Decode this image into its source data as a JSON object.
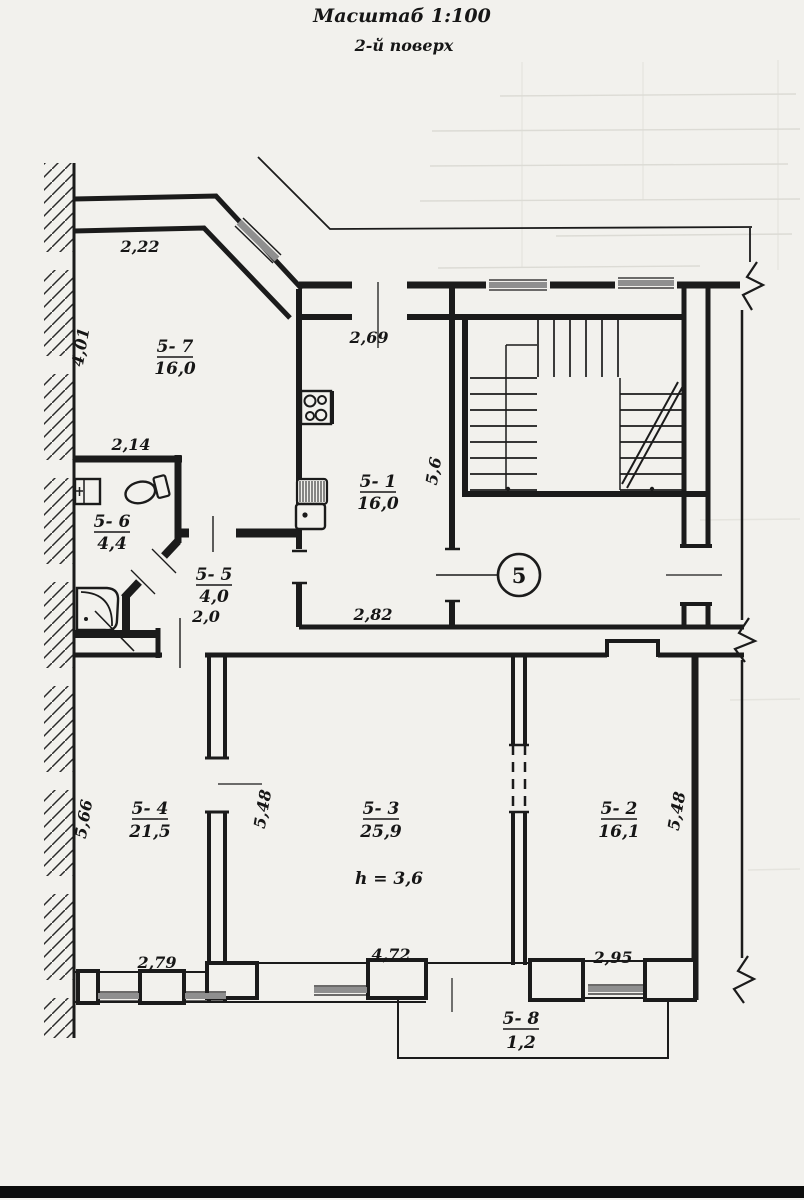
{
  "title": "Масштаб 1:100",
  "subtitle": "2-й поверх",
  "apartment_number": "5",
  "height_note": "h = 3,6",
  "rooms": [
    {
      "id": "5- 7",
      "area": "16,0"
    },
    {
      "id": "5- 1",
      "area": "16,0"
    },
    {
      "id": "5- 6",
      "area": "4,4"
    },
    {
      "id": "5- 5",
      "area": "4,0"
    },
    {
      "id": "5- 4",
      "area": "21,5"
    },
    {
      "id": "5- 3",
      "area": "25,9"
    },
    {
      "id": "5- 2",
      "area": "16,1"
    },
    {
      "id": "5- 8",
      "area": "1,2"
    }
  ],
  "dimensions": {
    "room_5_7_top": "2,22",
    "room_5_7_left": "4,01",
    "kitchen_top": "2,69",
    "kitchen_right": "5,6",
    "kitchen_bottom": "2,82",
    "bathroom_top": "2,14",
    "hall_width": "2,0",
    "room_5_4_left": "5,66",
    "room_5_4_right": "5,48",
    "room_5_4_bottom": "2,79",
    "room_5_3_bottom": "4,72",
    "room_5_2_right": "5,48",
    "room_5_2_bottom": "2,95"
  },
  "colors": {
    "paper": "#f2f1ed",
    "ink": "#1b1b1b",
    "window_gray": "#8f8f8f"
  }
}
